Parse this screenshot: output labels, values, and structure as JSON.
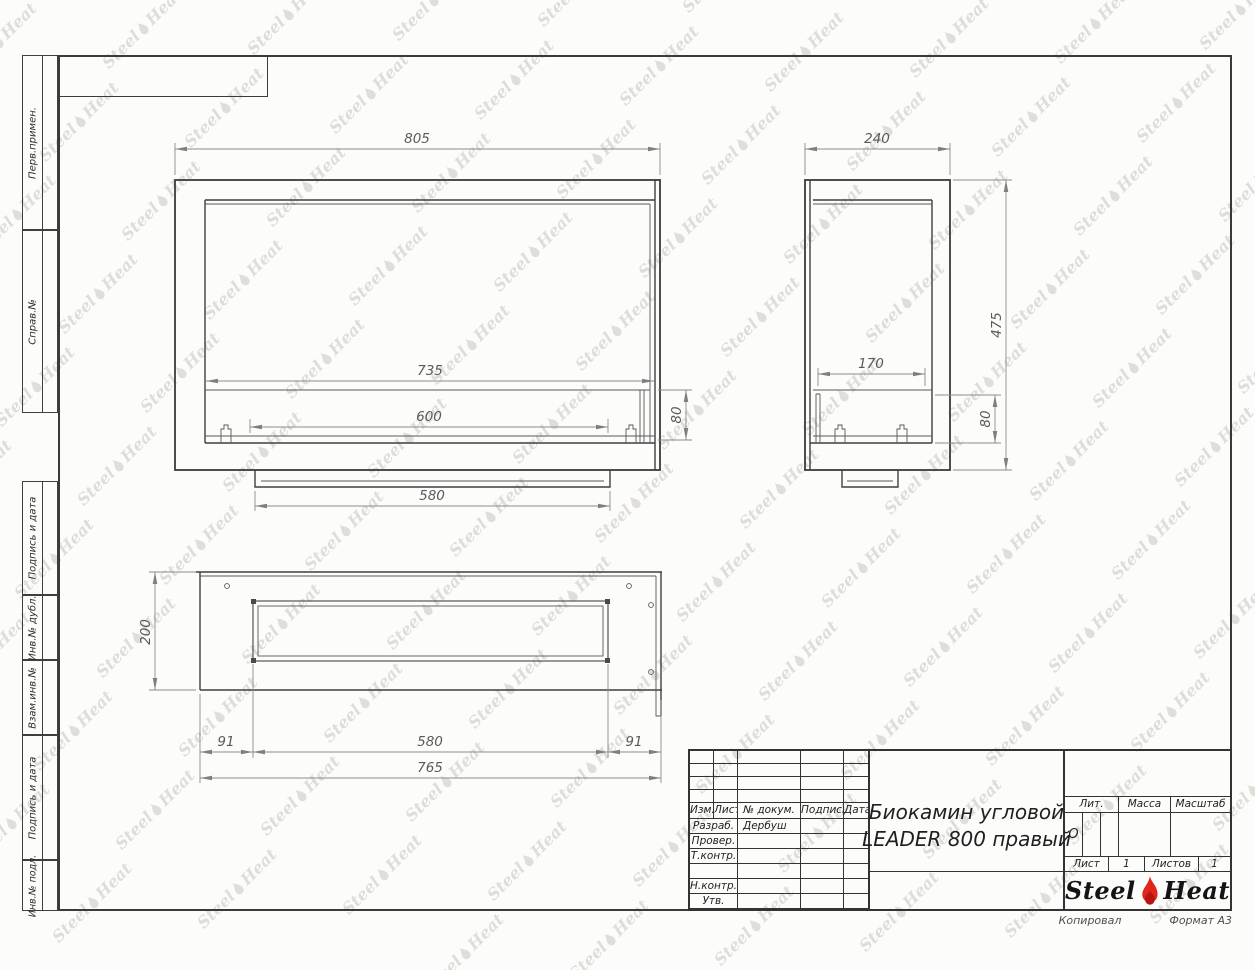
{
  "sheet": {
    "below_frame_left": "Копировал",
    "below_frame_right": "Формат А3"
  },
  "margin_labels": {
    "items": [
      "Перв.примен.",
      "Справ.№",
      "Подпись и дата",
      "Инв.№ дубл.",
      "Взам.инв.№",
      "Подпись и дата",
      "Инв.№ подл."
    ]
  },
  "views": {
    "front": {
      "overall_width": "805",
      "opening_width": "735",
      "burner_width": "600",
      "base_width": "580",
      "burner_height": "80"
    },
    "side": {
      "overall_depth": "240",
      "overall_height": "475",
      "burner_depth": "170",
      "burner_height": "80"
    },
    "top": {
      "overall_depth": "200",
      "left_offset": "91",
      "slot_width": "580",
      "right_offset": "91",
      "overall_width": "765"
    }
  },
  "title_block": {
    "rev_header": {
      "izm": "Изм.",
      "list": "Лист",
      "doc": "№ докум.",
      "sign": "Подпись",
      "date": "Дата"
    },
    "sign_rows": [
      {
        "label": "Разраб.",
        "name": "Дербуш"
      },
      {
        "label": "Провер.",
        "name": ""
      },
      {
        "label": "Т.контр.",
        "name": ""
      },
      {
        "label": "",
        "name": ""
      },
      {
        "label": "Н.контр.",
        "name": ""
      },
      {
        "label": "Утв.",
        "name": ""
      }
    ],
    "title_line1": "Биокамин угловой",
    "title_line2": "LEADER 800 правый",
    "lit_label": "Лит.",
    "lit_value": "О",
    "mass_label": "Масса",
    "scale_label": "Масштаб",
    "sheet_label": "Лист",
    "sheet_value": "1",
    "sheets_label": "Листов",
    "sheets_value": "1",
    "logo": {
      "steel": "Steel",
      "heat": "Heat"
    }
  },
  "watermark": {
    "steel": "Steel",
    "heat": "Heat"
  },
  "colors": {
    "flame_red": "#e2251b",
    "flame_dark": "#b5150e",
    "object_line": "#3d3d3d",
    "dim_line": "#8c8c8c",
    "watermark": "#b9b3aa"
  }
}
